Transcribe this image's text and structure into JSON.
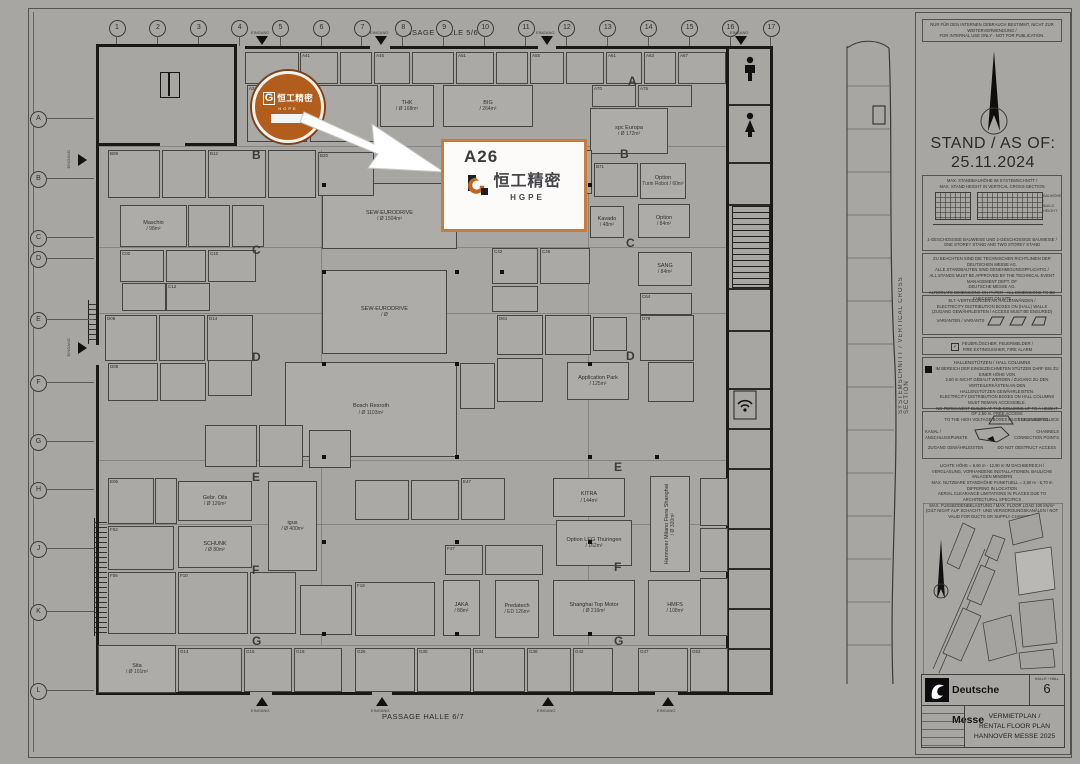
{
  "labels": {
    "passage_top": "PASSAGE HALLE 5/6",
    "passage_bottom": "PASSAGE HALLE 6/7",
    "entrance": "EINGANG",
    "cross_section": "SYSTEMSCHNITT / VERTICAL CROSS SECTION"
  },
  "callout": {
    "stand_id": "A26",
    "brand_cn": "恒工精密",
    "brand_en": "HGPE",
    "g_mark": "G"
  },
  "logo_circle": {
    "g_mark": "G",
    "brand_cn": "恒工精密",
    "brand_en": "HGPE"
  },
  "colors": {
    "logo_orange": "#b35d1c",
    "callout_border": "#c87b3c",
    "g_orange": "#c1661d",
    "text_dark": "#45454b"
  },
  "sidebar": {
    "disclaimer": [
      "NUR FÜR DEN INTERNEN GEBRAUCH BESTIMMT, NICHT ZUR WEITERVERWENDUNG /",
      "FOR INTERNAL USE ONLY - NOT FOR PUBLICATION."
    ],
    "stand_as_of_label": "STAND / AS OF:",
    "stand_as_of_date": "25.11.2024",
    "max_box": {
      "heading": [
        "MAX. STANDBAUHÖHE IM SYSTEMSCHNITT /",
        "MAX. STAND HEIGHT IN VERTICAL CROSS-SECTION"
      ],
      "side_label": [
        "BAUHÖHE /",
        "BUILD HEIGHT"
      ],
      "caption": [
        "1-GESCHOSSIGE BAUWEISE UND 2-GESCHOSSIGE BAUWEISE /",
        "ONE STOREY STAND AND TWO STOREY STAND"
      ]
    },
    "approval_lines": [
      "ZU BEACHTEN SIND DIE TECHNISCHEN RICHTLINIEN DER DEUTSCHEN MESSE AG.",
      "ALLE STANDBAUTEN SIND GENEHMIGUNGSPFLICHTIG /",
      "ALL STANDS MUST BE APPROVED BY THE TECHNICAL EVENT MANAGEMENT DEPT. OF",
      "DEUTSCHE MESSE AG.",
      "ALTERNATE DIMENSIONS ON PAPER - ALL DIMENSIONS TO BE CHECKED ON SITE"
    ],
    "elt_box": {
      "lines": [
        "ELT.-VERTEILUNGEN AN HALLENWÄNDEN /",
        "ELECTRICITY DISTRIBUTION BOXES ON (HALL) WALLS",
        "(ZUGANG GEWÄHRLEISTEN / ACCESS MUST BE ENSURED)"
      ],
      "variants_label": "VARIANTEN / VARIANTS"
    },
    "fire_box": [
      "FEUERLÖSCHER, FEUERMELDER /",
      "FIRE EXTINGUISHER, FIRE ALARM"
    ],
    "columns_box": {
      "heading": "HALLENSTÜTZEN / HALL COLUMNS",
      "lines": [
        "IM BEREICH DER EINGEZEICHNETEN STÜTZEN DARF BIS ZU EINER HÖHE VON",
        "2,50 m NICHT GEBAUT WERDEN / ZUGANG ZU DEN VERTEILERKÄSTEN AN DEN",
        "HALLENSTÜTZEN GEWÄHRLEISTEN.",
        "ELECTRICITY DISTRIBUTION BOXES ON HALL COLUMNS MUST REMAIN ACCESSIBLE.",
        "NO PERMANENT BUILDS AT THE COLUMNS UP TO A HEIGHT OF 2,50 m. FREE ACCESS",
        "TO THE HIGH VOLTAGE BOXES MUST BE ENSURED."
      ]
    },
    "sluice_box": {
      "sluice_label": "SCHLEUSE / SLUICE",
      "kanal_label": [
        "KANAL /",
        "ANSCHLUSSPUNKTE"
      ],
      "channels_label": [
        "CHANNELS",
        "CONNECTION POINTS"
      ],
      "access_de": "ZUGANG GEWÄHRLEISTEN",
      "access_en": "DO NOT OBSTRUCT ACCESS"
    },
    "clearance_lines": [
      "LICHTE HÖHE = 6,60 m - 12,90 m IM DACHBEREICH /",
      "VERGLASUNG, VORHANDENE INSTALLATIONEN, BAULICHE ANLAGEN MINDERN",
      "MAX. NUTZBARE STANDHÖHE PUNKTUELL = 2,50 m - 5,70 m DIFFERING IN LOCATION",
      "AERIAL CLEARANCE LIMITATIONS IN PLACES DUE TO ARCHITECTURAL SPECIFICS",
      "MAX. FUSSBODENBELASTUNG / MAX. FLOOR LOAD 100 kN/m²",
      "(GILT NICHT AUF SCHACHT- UND VERSORGUNGSKANÄLEN / NOT VALID FOR DUCTS OR SUPPLY CHANNELS)"
    ],
    "scale_labels": [
      "0",
      "5",
      "10",
      "15",
      "20m"
    ]
  },
  "title_block": {
    "publisher": "Deutsche Messe",
    "hall_label": "HALLE / HALL",
    "hall_number": "6",
    "plan_title": [
      "VERMIETPLAN /",
      "RENTAL FLOOR PLAN",
      "HANNOVER MESSE 2025"
    ]
  },
  "plan": {
    "grid_columns": [
      "1",
      "2",
      "3",
      "4",
      "5",
      "6",
      "7",
      "8",
      "9",
      "10",
      "11",
      "12",
      "13",
      "14",
      "15",
      "16",
      "17"
    ],
    "grid_x0": 116,
    "grid_dx": 40.9,
    "grid_rows": [
      "A",
      "B",
      "C",
      "D",
      "E",
      "F",
      "G",
      "H",
      "J",
      "K",
      "L"
    ],
    "row_y": [
      118,
      178,
      237,
      258,
      319,
      382,
      441,
      489,
      548,
      611,
      690
    ],
    "aisle_letters": [
      {
        "t": "A",
        "x": 628,
        "y": 74
      },
      {
        "t": "B",
        "x": 620,
        "y": 147
      },
      {
        "t": "B",
        "x": 252,
        "y": 148
      },
      {
        "t": "C",
        "x": 626,
        "y": 236
      },
      {
        "t": "C",
        "x": 252,
        "y": 243
      },
      {
        "t": "D",
        "x": 626,
        "y": 349
      },
      {
        "t": "D",
        "x": 252,
        "y": 350
      },
      {
        "t": "E",
        "x": 614,
        "y": 460
      },
      {
        "t": "E",
        "x": 252,
        "y": 470
      },
      {
        "t": "F",
        "x": 614,
        "y": 560
      },
      {
        "t": "F",
        "x": 252,
        "y": 563
      },
      {
        "t": "G",
        "x": 614,
        "y": 634
      },
      {
        "t": "G",
        "x": 252,
        "y": 634
      }
    ],
    "walls": [
      [
        245,
        46,
        125,
        3
      ],
      [
        390,
        46,
        148,
        3
      ],
      [
        556,
        46,
        170,
        3
      ],
      [
        96,
        44,
        141,
        3
      ],
      [
        96,
        44,
        3,
        101
      ],
      [
        234,
        44,
        3,
        101
      ],
      [
        96,
        143,
        64,
        3
      ],
      [
        185,
        143,
        52,
        3
      ],
      [
        96,
        145,
        3,
        200
      ],
      [
        96,
        365,
        3,
        330
      ],
      [
        96,
        692,
        154,
        3
      ],
      [
        272,
        692,
        100,
        3
      ],
      [
        392,
        692,
        263,
        3
      ],
      [
        678,
        692,
        48,
        3
      ],
      [
        726,
        46,
        3,
        649
      ],
      [
        770,
        46,
        3,
        649
      ],
      [
        726,
        46,
        47,
        3
      ],
      [
        726,
        692,
        47,
        3
      ]
    ],
    "strip_line_y": [
      104,
      162,
      204,
      288,
      330,
      388,
      428,
      468,
      528,
      568,
      608,
      648
    ],
    "hairlines": [
      [
        98,
        146,
        628,
        1
      ],
      [
        98,
        247,
        628,
        1
      ],
      [
        98,
        313,
        628,
        1
      ],
      [
        98,
        460,
        628,
        1
      ],
      [
        98,
        524,
        628,
        1
      ],
      [
        98,
        645,
        628,
        1
      ],
      [
        321,
        150,
        1,
        495
      ],
      [
        588,
        150,
        1,
        495
      ]
    ],
    "columns": [
      [
        322,
        183
      ],
      [
        455,
        183
      ],
      [
        588,
        183
      ],
      [
        322,
        270
      ],
      [
        455,
        270
      ],
      [
        500,
        270
      ],
      [
        322,
        362
      ],
      [
        455,
        362
      ],
      [
        588,
        362
      ],
      [
        322,
        455
      ],
      [
        455,
        455
      ],
      [
        588,
        455
      ],
      [
        655,
        455
      ],
      [
        322,
        540
      ],
      [
        455,
        540
      ],
      [
        588,
        540
      ],
      [
        322,
        632
      ],
      [
        455,
        632
      ],
      [
        588,
        632
      ]
    ],
    "entrance_top_x": [
      262,
      381,
      547,
      741
    ],
    "entrance_bottom_x": [
      262,
      382,
      548,
      668
    ],
    "entrance_left_y": [
      160,
      348
    ],
    "stands": [
      {
        "x": 380,
        "y": 85,
        "w": 52,
        "h": 40,
        "l": "THK",
        "s": "/ Ø 168m²"
      },
      {
        "x": 443,
        "y": 85,
        "w": 88,
        "h": 40,
        "l": "BIG",
        "s": "/ 264m²"
      },
      {
        "x": 590,
        "y": 108,
        "w": 76,
        "h": 44,
        "l": "spc Europa",
        "s": "/ Ø 172m²"
      },
      {
        "x": 322,
        "y": 183,
        "w": 133,
        "h": 64,
        "l": "SEW-EURODRIVE",
        "s": "/ Ø 1504m²"
      },
      {
        "x": 322,
        "y": 270,
        "w": 123,
        "h": 82,
        "l": "SEW-EURODRIVE",
        "s": "/ Ø"
      },
      {
        "x": 285,
        "y": 362,
        "w": 170,
        "h": 93,
        "l": "Bosch Rexroth",
        "s": "/ Ø 1103m²"
      },
      {
        "x": 120,
        "y": 205,
        "w": 65,
        "h": 40,
        "l": "Maschio",
        "s": "/ 98m²"
      },
      {
        "x": 640,
        "y": 163,
        "w": 44,
        "h": 34,
        "l": "Option",
        "s": "Turin Robot / 60m²"
      },
      {
        "x": 590,
        "y": 206,
        "w": 32,
        "h": 30,
        "l": "Kavado",
        "s": "/ 48m²"
      },
      {
        "x": 638,
        "y": 204,
        "w": 50,
        "h": 32,
        "l": "Option",
        "s": "/ 84m²"
      },
      {
        "x": 638,
        "y": 252,
        "w": 52,
        "h": 32,
        "l": "SANG",
        "s": "/ 84m²"
      },
      {
        "x": 567,
        "y": 362,
        "w": 60,
        "h": 36,
        "l": "Application Park",
        "s": "/ 125m²"
      },
      {
        "x": 178,
        "y": 481,
        "w": 72,
        "h": 38,
        "l": "Gebr. Oils",
        "s": "/ Ø 126m²"
      },
      {
        "x": 268,
        "y": 481,
        "w": 47,
        "h": 88,
        "l": "igus",
        "s": "/ Ø 400m²"
      },
      {
        "x": 553,
        "y": 478,
        "w": 70,
        "h": 37,
        "l": "KITRA",
        "s": "/ 144m²"
      },
      {
        "x": 650,
        "y": 476,
        "w": 38,
        "h": 94,
        "l": "Hannover Milano Fiera Shanghai",
        "s": "/ Ø 320m²",
        "v": 1
      },
      {
        "x": 556,
        "y": 520,
        "w": 74,
        "h": 44,
        "l": "Option LEG Thüringen",
        "s": "/ 162m²"
      },
      {
        "x": 178,
        "y": 526,
        "w": 72,
        "h": 40,
        "l": "SCHUNK",
        "s": "/ Ø 80m²"
      },
      {
        "x": 443,
        "y": 580,
        "w": 35,
        "h": 54,
        "l": "JAKA",
        "s": "/ 88m²"
      },
      {
        "x": 495,
        "y": 580,
        "w": 42,
        "h": 56,
        "l": "Predatech",
        "s": "/ ED 126m²"
      },
      {
        "x": 553,
        "y": 580,
        "w": 80,
        "h": 54,
        "l": "Shanghai Top Motor",
        "s": "/ Ø 216m²"
      },
      {
        "x": 648,
        "y": 580,
        "w": 52,
        "h": 54,
        "l": "HMFS",
        "s": "/ 108m²"
      },
      {
        "x": 98,
        "y": 645,
        "w": 76,
        "h": 46,
        "l": "Sita",
        "s": "/ Ø 101m²"
      }
    ],
    "filler": [
      [
        245,
        52,
        52,
        30,
        ""
      ],
      [
        300,
        52,
        36,
        30,
        "A41"
      ],
      [
        340,
        52,
        30,
        30,
        ""
      ],
      [
        374,
        52,
        34,
        30,
        "A45"
      ],
      [
        412,
        52,
        40,
        30,
        ""
      ],
      [
        456,
        52,
        36,
        30,
        "A51"
      ],
      [
        496,
        52,
        30,
        30,
        ""
      ],
      [
        530,
        52,
        32,
        30,
        "A55"
      ],
      [
        566,
        52,
        36,
        30,
        ""
      ],
      [
        606,
        52,
        34,
        30,
        "A61"
      ],
      [
        644,
        52,
        30,
        30,
        "A63"
      ],
      [
        678,
        52,
        46,
        30,
        "A67"
      ],
      [
        247,
        85,
        58,
        55,
        "A34"
      ],
      [
        310,
        85,
        66,
        55,
        "A38"
      ],
      [
        592,
        85,
        42,
        20,
        "A70"
      ],
      [
        638,
        85,
        52,
        20,
        "A75"
      ],
      [
        108,
        150,
        50,
        46,
        "B08"
      ],
      [
        162,
        150,
        42,
        46,
        ""
      ],
      [
        208,
        150,
        56,
        46,
        "B12"
      ],
      [
        268,
        150,
        46,
        46,
        ""
      ],
      [
        318,
        152,
        54,
        42,
        "B20"
      ],
      [
        500,
        150,
        46,
        42,
        ""
      ],
      [
        550,
        150,
        40,
        42,
        ""
      ],
      [
        594,
        163,
        42,
        32,
        "B71"
      ],
      [
        188,
        205,
        40,
        40,
        ""
      ],
      [
        232,
        205,
        30,
        40,
        ""
      ],
      [
        120,
        250,
        42,
        30,
        "C02"
      ],
      [
        166,
        250,
        38,
        30,
        ""
      ],
      [
        208,
        250,
        46,
        30,
        "C10"
      ],
      [
        122,
        283,
        42,
        26,
        ""
      ],
      [
        166,
        283,
        42,
        26,
        "C12"
      ],
      [
        492,
        248,
        44,
        34,
        "C42"
      ],
      [
        540,
        248,
        48,
        34,
        "C46"
      ],
      [
        492,
        286,
        44,
        24,
        ""
      ],
      [
        640,
        293,
        50,
        20,
        "C64"
      ],
      [
        105,
        315,
        50,
        44,
        "D06"
      ],
      [
        159,
        315,
        44,
        44,
        ""
      ],
      [
        207,
        315,
        44,
        44,
        "D14"
      ],
      [
        108,
        363,
        48,
        36,
        "D08"
      ],
      [
        160,
        363,
        44,
        36,
        ""
      ],
      [
        208,
        360,
        42,
        34,
        ""
      ],
      [
        497,
        315,
        44,
        38,
        "D61"
      ],
      [
        545,
        315,
        44,
        38,
        ""
      ],
      [
        593,
        317,
        32,
        32,
        ""
      ],
      [
        640,
        315,
        52,
        44,
        "D79"
      ],
      [
        648,
        362,
        44,
        38,
        ""
      ],
      [
        460,
        363,
        33,
        44,
        ""
      ],
      [
        497,
        358,
        44,
        42,
        ""
      ],
      [
        205,
        425,
        50,
        40,
        ""
      ],
      [
        259,
        425,
        42,
        40,
        ""
      ],
      [
        309,
        430,
        40,
        36,
        ""
      ],
      [
        108,
        478,
        44,
        44,
        "E06"
      ],
      [
        155,
        478,
        20,
        44,
        ""
      ],
      [
        355,
        480,
        52,
        38,
        ""
      ],
      [
        411,
        480,
        46,
        38,
        ""
      ],
      [
        461,
        478,
        42,
        40,
        "E47"
      ],
      [
        700,
        478,
        26,
        46,
        ""
      ],
      [
        700,
        528,
        26,
        42,
        ""
      ],
      [
        108,
        526,
        64,
        42,
        "F02"
      ],
      [
        108,
        572,
        66,
        60,
        "F06"
      ],
      [
        178,
        572,
        68,
        60,
        "F10"
      ],
      [
        250,
        572,
        44,
        60,
        ""
      ],
      [
        300,
        585,
        50,
        48,
        ""
      ],
      [
        355,
        582,
        78,
        52,
        "F18"
      ],
      [
        445,
        545,
        36,
        28,
        "F47"
      ],
      [
        485,
        545,
        56,
        28,
        ""
      ],
      [
        700,
        578,
        26,
        56,
        ""
      ],
      [
        178,
        648,
        62,
        42,
        "G14"
      ],
      [
        244,
        648,
        46,
        42,
        "G16"
      ],
      [
        294,
        648,
        46,
        42,
        "G18"
      ],
      [
        355,
        648,
        58,
        42,
        "G26"
      ],
      [
        417,
        648,
        52,
        42,
        "G30"
      ],
      [
        473,
        648,
        50,
        42,
        "G34"
      ],
      [
        527,
        648,
        42,
        42,
        "G38"
      ],
      [
        573,
        648,
        38,
        42,
        "G42"
      ],
      [
        638,
        648,
        48,
        42,
        "G47"
      ],
      [
        690,
        648,
        36,
        42,
        "G52"
      ]
    ]
  }
}
